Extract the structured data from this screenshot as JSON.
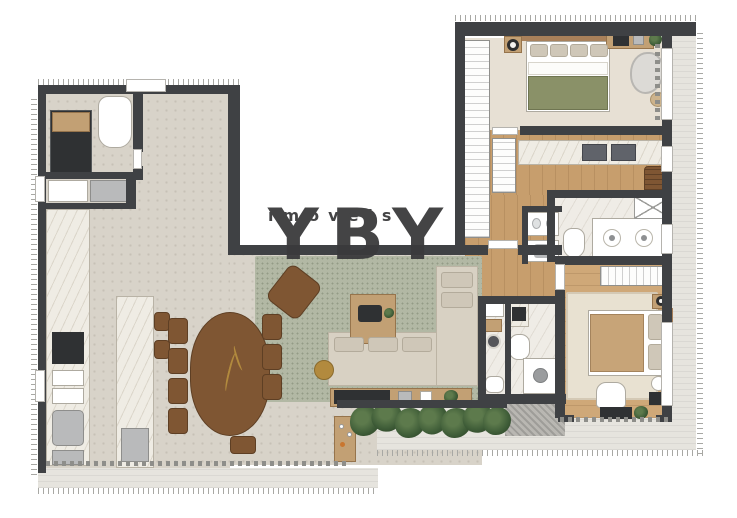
{
  "watermark": {
    "brand": "YBY",
    "tagline": "imóveis"
  },
  "palette": {
    "wall": "#3f4144",
    "tile": "#d8d3c9",
    "wood": "#c79e6d",
    "wood2": "#cfa878",
    "cream": "#e7e0d4",
    "stone": "#efece6",
    "terrace": "#e6e4de",
    "marble": "#efece4",
    "rug_green": "#b2b8a4",
    "rug_beige": "#e8e1d1",
    "sofa": "#d8d1c3",
    "green_blanket": "#8a9168",
    "tan_blanket": "#c7a478",
    "wood_furn": "#7f5633",
    "wood_light": "#c2a074",
    "plant": "#3f5d38",
    "dark_appliance": "#2f3133",
    "gold": "#b28a3e",
    "shaft": "#b9b7b2",
    "watermark": "#3a3a3c"
  }
}
